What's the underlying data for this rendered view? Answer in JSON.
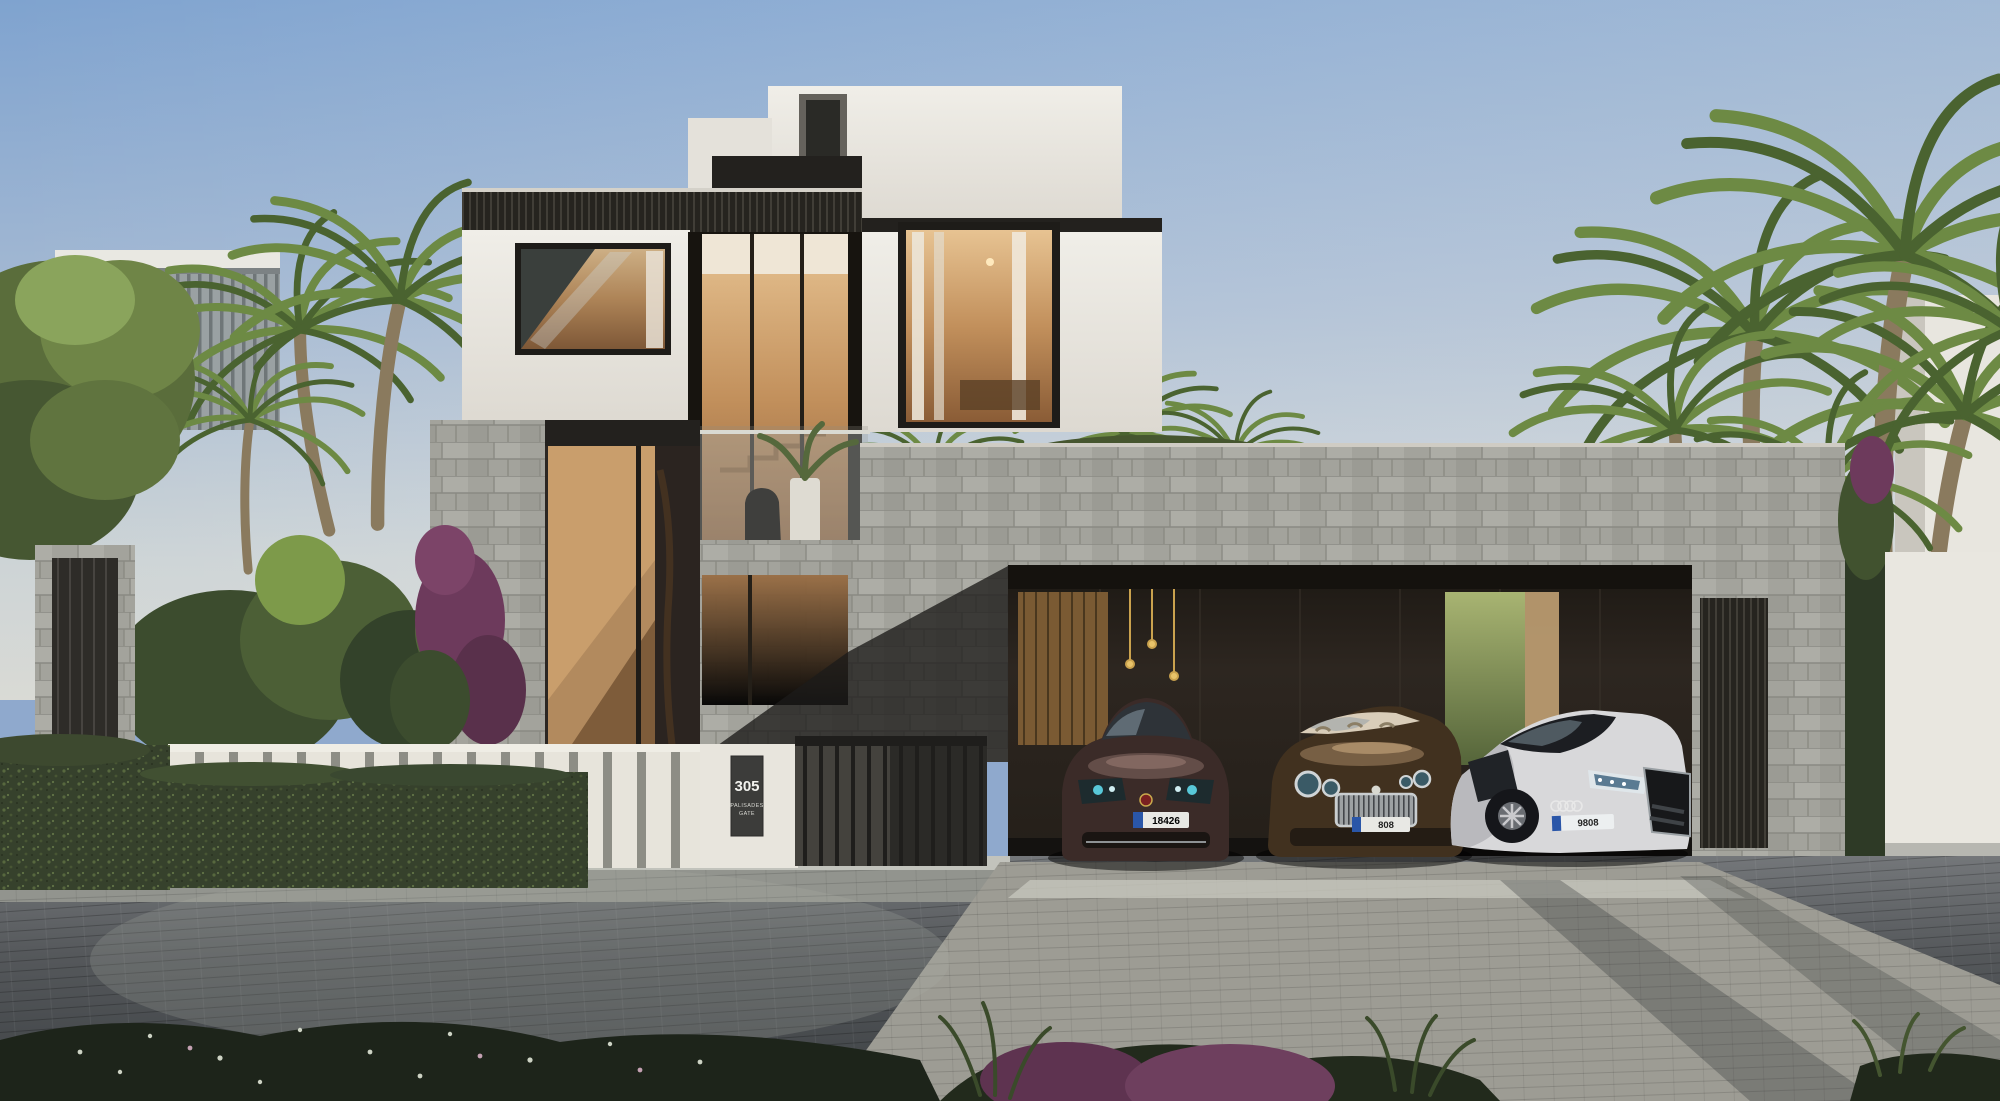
{
  "signage": {
    "house_number": "305",
    "community_line1": "PALISADES",
    "community_line2": "GATE"
  },
  "vehicles": [
    {
      "name": "dark-maroon-sedan",
      "plate": "18426"
    },
    {
      "name": "bronze-grand-tourer",
      "plate": "808"
    },
    {
      "name": "white-supercar",
      "plate": "9808"
    }
  ],
  "palette": {
    "sky_top": "#7fa3cf",
    "sky_horizon": "#d6d9d6",
    "white_wall": "#edebe4",
    "stone": "#a3a39c",
    "dark_metal": "#26241f",
    "warm_glass": "#c79a66",
    "bronze_door": "#b28a5e",
    "hedge_green": "#36412c",
    "palm_green": "#5f7d3e",
    "street": "#55585b",
    "driveway": "#9d9c94",
    "plate_blue": "#2a56a8",
    "sign_plaque": "#3c3c3a"
  }
}
